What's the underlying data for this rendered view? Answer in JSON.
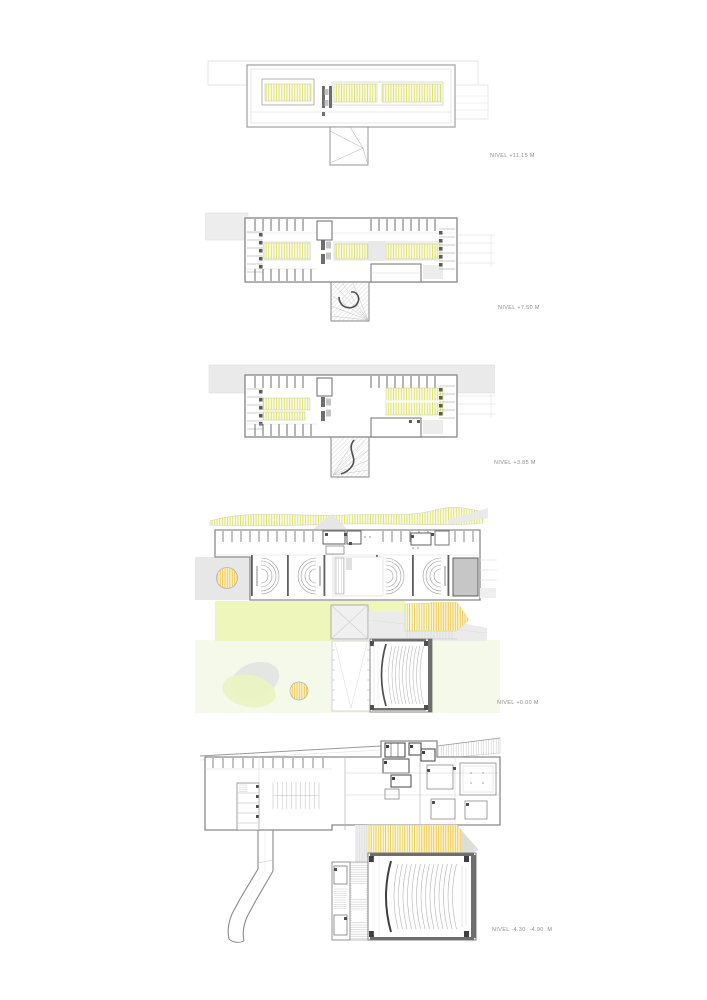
{
  "sheet": {
    "background": "#ffffff",
    "label_color": "#8c8c8c"
  },
  "plans": [
    {
      "id": "nivel-plus-11-15",
      "name": "roof-plan",
      "label": "NIVEL +11.15 M"
    },
    {
      "id": "nivel-plus-7-50",
      "name": "second-floor-plan",
      "label": "NIVEL +7.50 M"
    },
    {
      "id": "nivel-plus-3-85",
      "name": "first-floor-plan",
      "label": "NIVEL +3.85 M"
    },
    {
      "id": "nivel-0-00",
      "name": "ground-floor-plan",
      "label": "NIVEL +0.00 M"
    },
    {
      "id": "nivel-minus-4-30",
      "name": "basement-plan",
      "label": "NIVEL -4.30  -4.90  M"
    }
  ],
  "colors": {
    "wall": "#8a8a8a",
    "wall_dark": "#5f5f5f",
    "context_gray": "#ececec",
    "skylight_hatch_yellow": "#dde06e",
    "tree_hatch_orange": "#eec23c",
    "lawn_green": "#eef6bb",
    "pale_green": "#f5f9ea"
  }
}
